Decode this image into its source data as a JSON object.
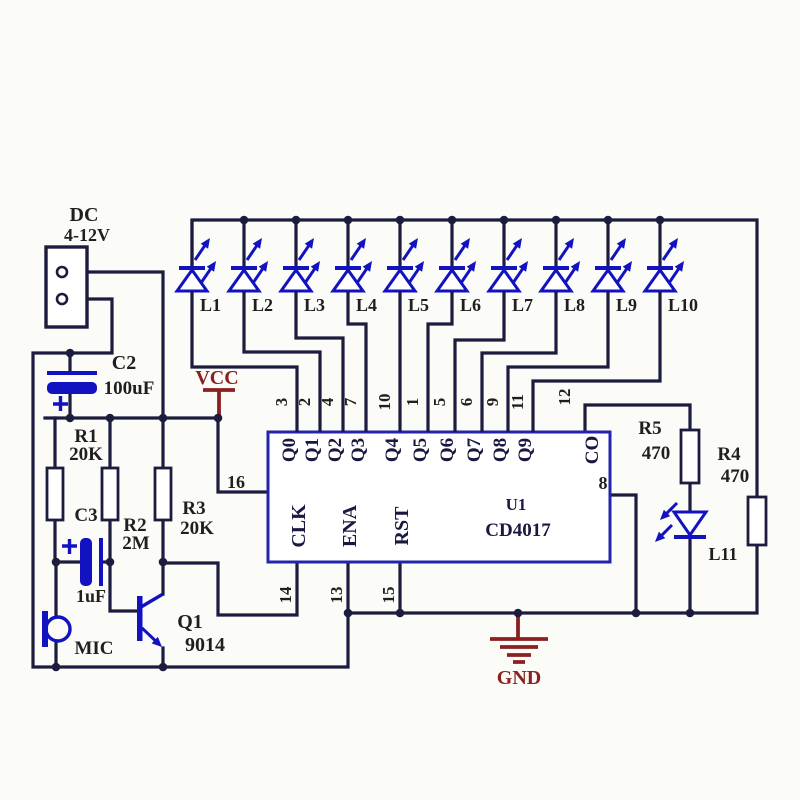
{
  "power_connector": {
    "label": "DC",
    "voltage": "4-12V"
  },
  "rails": {
    "vcc": "VCC",
    "gnd": "GND"
  },
  "components": {
    "c2": {
      "name": "C2",
      "value": "100uF"
    },
    "c3": {
      "name": "C3",
      "value": "1uF"
    },
    "r1": {
      "name": "R1",
      "value": "20K"
    },
    "r2": {
      "name": "R2",
      "value": "2M"
    },
    "r3": {
      "name": "R3",
      "value": "20K"
    },
    "r4": {
      "name": "R4",
      "value": "470"
    },
    "r5": {
      "name": "R5",
      "value": "470"
    },
    "mic": {
      "name": "MIC"
    },
    "q1": {
      "name": "Q1",
      "value": "9014"
    },
    "l11": {
      "name": "L11"
    }
  },
  "ic": {
    "designator": "U1",
    "part": "CD4017",
    "top_pins": [
      {
        "num": "3",
        "label": "Q0"
      },
      {
        "num": "2",
        "label": "Q1"
      },
      {
        "num": "4",
        "label": "Q2"
      },
      {
        "num": "7",
        "label": "Q3"
      },
      {
        "num": "10",
        "label": "Q4"
      },
      {
        "num": "1",
        "label": "Q5"
      },
      {
        "num": "5",
        "label": "Q6"
      },
      {
        "num": "6",
        "label": "Q7"
      },
      {
        "num": "9",
        "label": "Q8"
      },
      {
        "num": "11",
        "label": "Q9"
      }
    ],
    "carry_pin": {
      "num": "12",
      "label": "CO"
    },
    "bottom_pins": [
      {
        "num": "14",
        "label": "CLK"
      },
      {
        "num": "13",
        "label": "ENA"
      },
      {
        "num": "15",
        "label": "RST"
      }
    ],
    "vdd_pin_num": "16",
    "vss_pin_num": "8"
  },
  "leds": [
    "L1",
    "L2",
    "L3",
    "L4",
    "L5",
    "L6",
    "L7",
    "L8",
    "L9",
    "L10"
  ],
  "colors": {
    "wire": "#1c1c3e",
    "component_blue": "#1212c0",
    "ic_border": "#2323ab",
    "symbol_red": "#8b2020",
    "text": "#1f1f1f"
  }
}
